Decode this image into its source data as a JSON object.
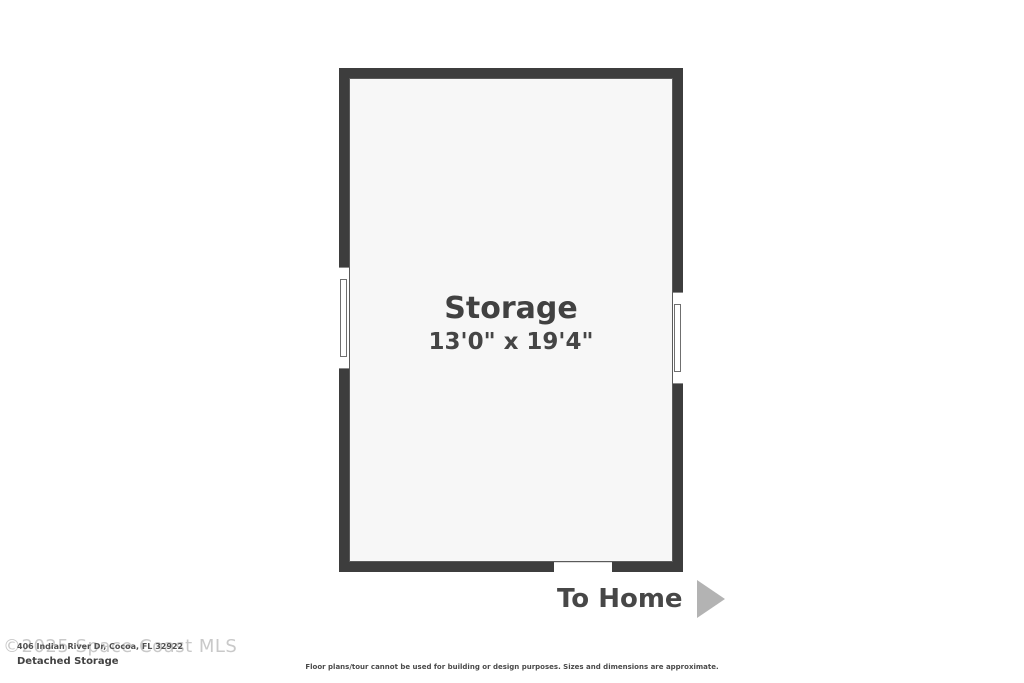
{
  "floorplan": {
    "room": {
      "name": "Storage",
      "dimensions": "13'0\" x 19'4\""
    },
    "features": {
      "windows": [
        "left-wall-window",
        "right-wall-window"
      ],
      "door": "bottom-wall-opening"
    },
    "exit_label": "To Home",
    "icons": {
      "to_home_arrow": "arrow-right-triangle"
    }
  },
  "footer": {
    "watermark": "©2025 Space Coast MLS",
    "address": "406 Indian River Dr, Cocoa, FL 32922",
    "plan_title": "Detached Storage",
    "disclaimer": "Floor plans/tour cannot be used for building or design purposes. Sizes and dimensions are approximate."
  },
  "colors": {
    "wall": "#3d3d3d",
    "floor": "#f7f7f7",
    "background": "#ffffff",
    "label_text": "#414141",
    "arrow": "#b3b3b3",
    "watermark": "#c9c9c9"
  }
}
